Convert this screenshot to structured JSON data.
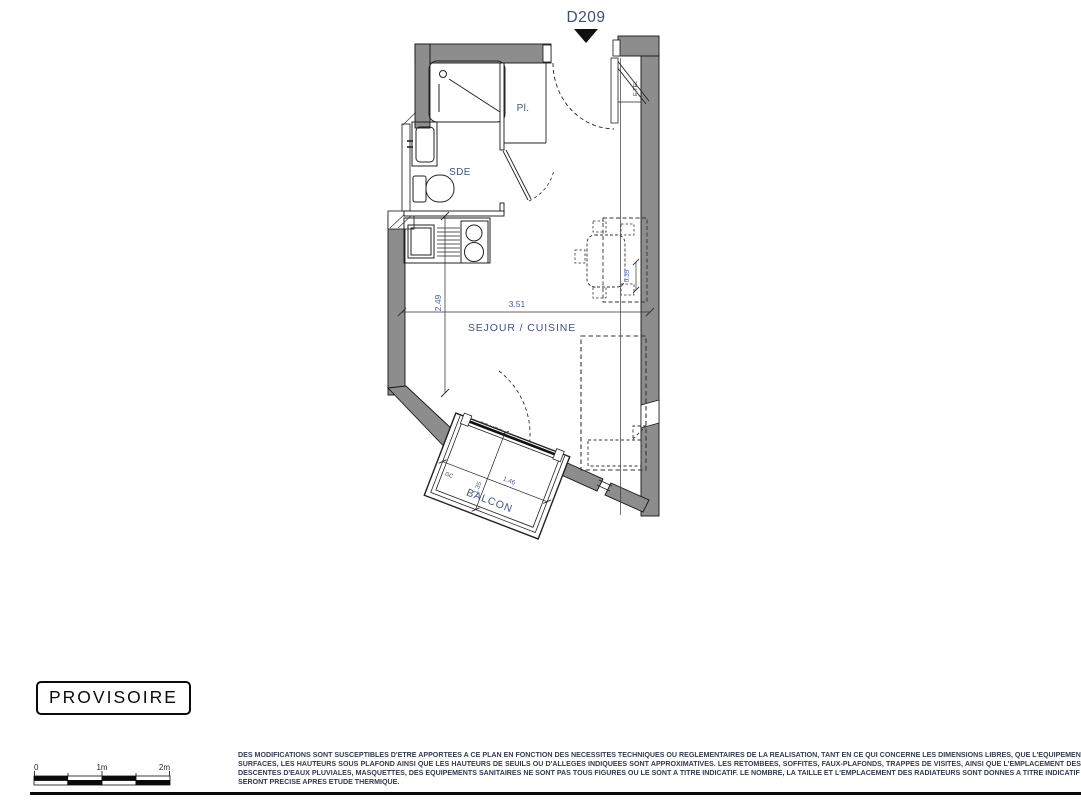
{
  "header": {
    "unit_label": "D209"
  },
  "plan": {
    "room_labels": {
      "sde": "SDE",
      "closet": "Pl.",
      "living": "SEJOUR / CUISINE",
      "balcony": "BALCON"
    },
    "annotations": {
      "electrical_panel": "E.TEL",
      "french_window": "PF VRE",
      "guardrail": "GC"
    },
    "dimensions": {
      "living_width_m": "3.51",
      "kitchen_depth_m": "2.49",
      "soffit_depth_m": "0.35",
      "balcony_width_m": "1.46",
      "balcony_depth_m": "1.35"
    },
    "colors": {
      "wall_fill": "#8d8d8d",
      "line": "#1a1a1a",
      "label_blue": "#46527c",
      "dim_blue": "#4d5d92",
      "dim_accent_blue": "#3c64c1"
    }
  },
  "stamp": {
    "label": "PROVISOIRE"
  },
  "scale_bar": {
    "tick_labels": [
      "0",
      "1m",
      "2m"
    ]
  },
  "disclaimer": {
    "lines": [
      "DES MODIFICATIONS SONT SUSCEPTIBLES D'ETRE APPORTEES A CE PLAN EN FONCTION DES NECESSITES TECHNIQUES OU REGLEMENTAIRES DE LA REALISATION, TANT EN CE QUI CONCERNE LES DIMENSIONS LIBRES, QUE L'EQUIPEMENT. LES",
      "SURFACES, LES HAUTEURS SOUS PLAFOND AINSI QUE LES HAUTEURS DE SEUILS OU D'ALLEGES INDIQUEES SONT APPROXIMATIVES. LES RETOMBEES, SOFFITES, FAUX-PLAFONDS, TRAPPES DE VISITES, AINSI QUE L'EMPLACEMENT DES",
      "DESCENTES D'EAUX PLUVIALES, MASQUETTES, DES EQUIPEMENTS SANITAIRES NE SONT PAS TOUS FIGURES OU LE SONT A TITRE INDICATIF. LE NOMBRE, LA TAILLE ET L'EMPLACEMENT DES RADIATEURS SONT DONNES A TITRE INDICATIF ET",
      "SERONT PRECISE APRES ETUDE THERMIQUE."
    ]
  }
}
